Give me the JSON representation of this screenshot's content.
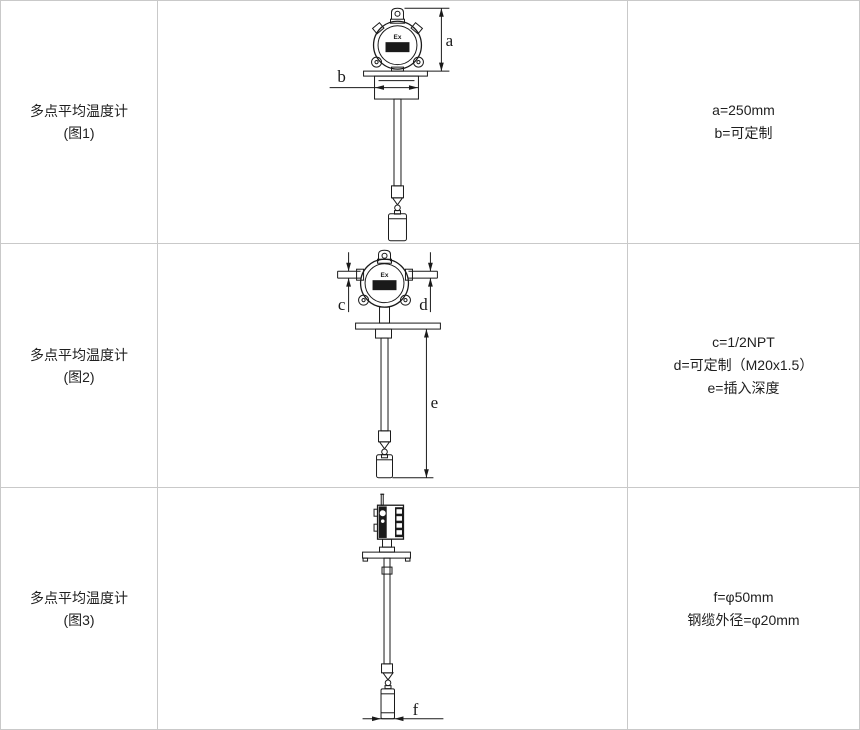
{
  "table": {
    "rows": [
      {
        "title_line1": "多点平均温度计",
        "title_line2": "(图1)",
        "figure": {
          "ex_mark": "Ex",
          "dim_a": "a",
          "dim_b": "b"
        },
        "specs": [
          "a=250mm",
          "b=可定制"
        ]
      },
      {
        "title_line1": "多点平均温度计",
        "title_line2": "(图2)",
        "figure": {
          "ex_mark": "Ex",
          "dim_c": "c",
          "dim_d": "d",
          "dim_e": "e"
        },
        "specs": [
          "c=1/2NPT",
          "d=可定制（M20x1.5）",
          "e=插入深度"
        ]
      },
      {
        "title_line1": "多点平均温度计",
        "title_line2": "(图3)",
        "figure": {
          "dim_f": "f"
        },
        "specs": [
          "f=φ50mm",
          "钢缆外径=φ20mm"
        ]
      }
    ]
  },
  "colors": {
    "border": "#c9c9c9",
    "drawing_line": "#1a1a1a",
    "text": "#1f1f1f"
  }
}
